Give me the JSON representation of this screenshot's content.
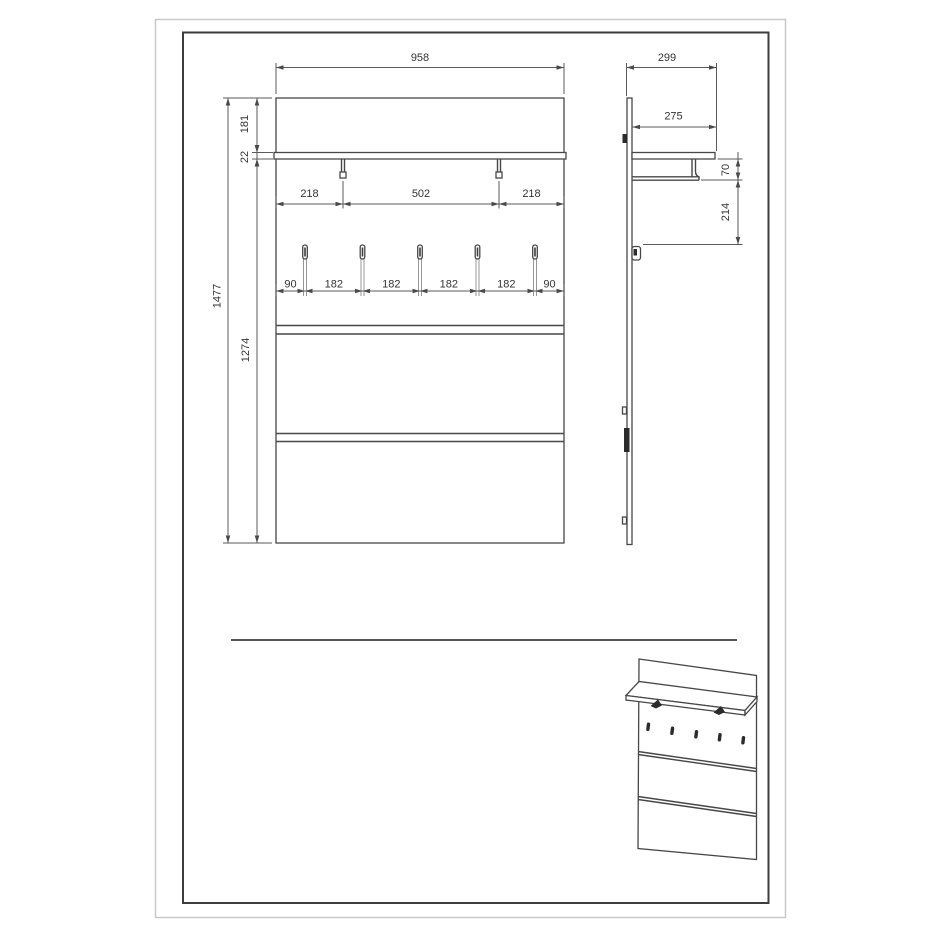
{
  "drawing": {
    "kind": "furniture dimension drawing",
    "outer_border_color": "#c8c8c8",
    "frame_color": "#3d3d3d",
    "line_color": "#474747",
    "dim_color": "#5a5a5a",
    "text_color": "#333333",
    "background": "#ffffff"
  },
  "front_view": {
    "width": "958",
    "top_board_height": "181",
    "shelf_thickness": "22",
    "total_height": "1477",
    "body_height": "1274",
    "support_spacing": [
      "218",
      "502",
      "218"
    ],
    "hook_spacing": [
      "90",
      "182",
      "182",
      "182",
      "182",
      "90"
    ],
    "hook_count": 5,
    "groove_count": 2
  },
  "side_view": {
    "depth": "299",
    "shelf_depth": "275",
    "rail_drop": "70",
    "hook_drop": "214"
  }
}
